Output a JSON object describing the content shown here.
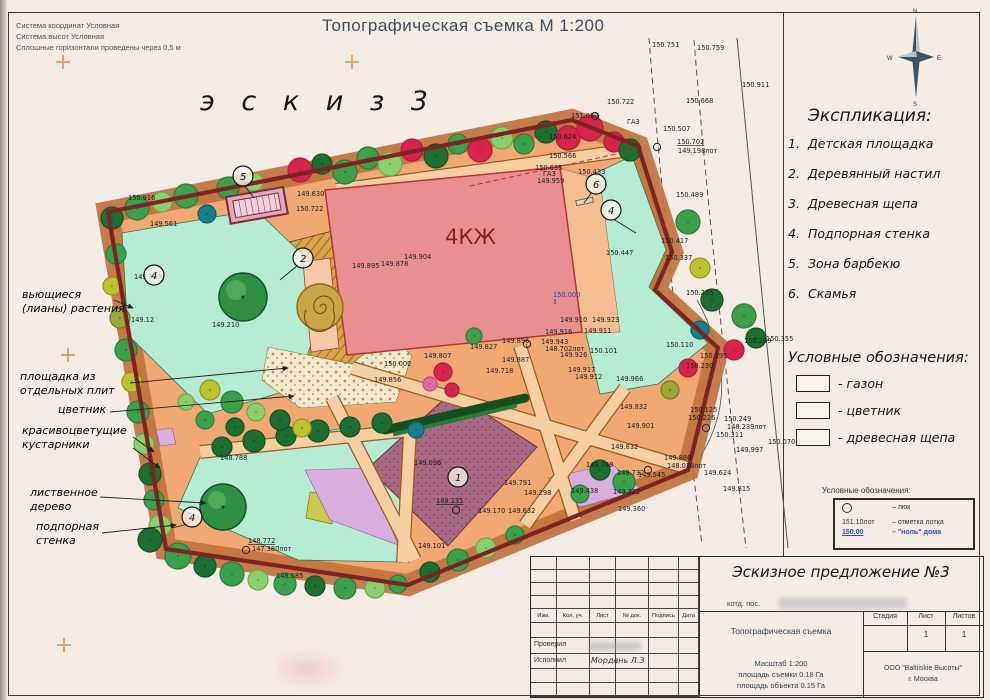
{
  "page": {
    "title": "Топографическая съемка М 1:200",
    "sketch_label": "э с к и з  3",
    "corner_notes": [
      "Система координат Условная",
      "Система высот Условная",
      "Сплошные горизонтали проведены через 0,5 м"
    ]
  },
  "compass": {
    "n": "N",
    "e": "E",
    "s": "S",
    "w": "W"
  },
  "explication": {
    "title": "Экспликация:",
    "items": [
      {
        "num": "1.",
        "label": "Детская площадка"
      },
      {
        "num": "2.",
        "label": "Деревянный настил"
      },
      {
        "num": "3.",
        "label": "Древесная щепа"
      },
      {
        "num": "4.",
        "label": "Подпорная стенка"
      },
      {
        "num": "5.",
        "label": "Зона барбекю"
      },
      {
        "num": "6.",
        "label": "Скамья"
      }
    ]
  },
  "legend": {
    "title": "Условные обозначения:",
    "items": [
      "газон",
      "цветник",
      "древесная щепа"
    ]
  },
  "legend_box": {
    "title": "Условные обозначения:",
    "rows": [
      {
        "value": "",
        "label": "–  люк",
        "symbol": "circle",
        "blue": false
      },
      {
        "value": "151.10лот",
        "label": "–  отметка лотка",
        "symbol": "",
        "blue": false
      },
      {
        "value": "150.00",
        "label": "–  \"ноль\" дома",
        "symbol": "",
        "blue": true
      }
    ]
  },
  "map": {
    "building_label": "4КЖ",
    "gas_label": "ГАЗ",
    "elevations": [
      {
        "v": "151.039",
        "x": 571,
        "y": 118
      },
      {
        "v": "150.722",
        "x": 607,
        "y": 104
      },
      {
        "v": "150.751",
        "x": 652,
        "y": 47
      },
      {
        "v": "150.759",
        "x": 697,
        "y": 50
      },
      {
        "v": "150.911",
        "x": 742,
        "y": 87
      },
      {
        "v": "150.668",
        "x": 686,
        "y": 103
      },
      {
        "v": "150.507",
        "x": 663,
        "y": 131
      },
      {
        "v": "150.702",
        "x": 677,
        "y": 144,
        "f": "u"
      },
      {
        "v": "149.198лот",
        "x": 678,
        "y": 153
      },
      {
        "v": "150.489",
        "x": 676,
        "y": 197
      },
      {
        "v": "150.417",
        "x": 661,
        "y": 243
      },
      {
        "v": "150.337",
        "x": 665,
        "y": 260
      },
      {
        "v": "150.205",
        "x": 686,
        "y": 295
      },
      {
        "v": "150.269",
        "x": 744,
        "y": 343
      },
      {
        "v": "150.355",
        "x": 766,
        "y": 341
      },
      {
        "v": "150.195",
        "x": 700,
        "y": 358
      },
      {
        "v": "150.230",
        "x": 686,
        "y": 368
      },
      {
        "v": "150.110",
        "x": 666,
        "y": 347
      },
      {
        "v": "150.125",
        "x": 690,
        "y": 412
      },
      {
        "v": "150.226",
        "x": 688,
        "y": 420
      },
      {
        "v": "150.249",
        "x": 724,
        "y": 421
      },
      {
        "v": "148.239лот",
        "x": 727,
        "y": 429
      },
      {
        "v": "150.311",
        "x": 716,
        "y": 437
      },
      {
        "v": "149.997",
        "x": 736,
        "y": 452
      },
      {
        "v": "150.070",
        "x": 768,
        "y": 444
      },
      {
        "v": "149.886",
        "x": 664,
        "y": 460
      },
      {
        "v": "148.038лот",
        "x": 667,
        "y": 468
      },
      {
        "v": "149.545",
        "x": 638,
        "y": 477
      },
      {
        "v": "149.624",
        "x": 704,
        "y": 475
      },
      {
        "v": "149.815",
        "x": 723,
        "y": 491
      },
      {
        "v": "149.360",
        "x": 618,
        "y": 511
      },
      {
        "v": "150.624",
        "x": 549,
        "y": 139
      },
      {
        "v": "150.566",
        "x": 549,
        "y": 158
      },
      {
        "v": "150.635",
        "x": 535,
        "y": 170
      },
      {
        "v": "149.959",
        "x": 537,
        "y": 183
      },
      {
        "v": "150.433",
        "x": 578,
        "y": 174
      },
      {
        "v": "149.630",
        "x": 297,
        "y": 196
      },
      {
        "v": "150.722",
        "x": 296,
        "y": 211
      },
      {
        "v": "150.916",
        "x": 128,
        "y": 200
      },
      {
        "v": "149.561",
        "x": 150,
        "y": 226
      },
      {
        "v": "149.339",
        "x": 134,
        "y": 279
      },
      {
        "v": "149.12",
        "x": 131,
        "y": 322
      },
      {
        "v": "149.210",
        "x": 212,
        "y": 327
      },
      {
        "v": "149.904",
        "x": 404,
        "y": 259
      },
      {
        "v": "149.895",
        "x": 352,
        "y": 268
      },
      {
        "v": "149.878",
        "x": 381,
        "y": 266
      },
      {
        "v": "150.447",
        "x": 606,
        "y": 255
      },
      {
        "v": "150.000",
        "x": 553,
        "y": 297,
        "f": "b"
      },
      {
        "v": "149.910",
        "x": 560,
        "y": 322
      },
      {
        "v": "149.923",
        "x": 592,
        "y": 322
      },
      {
        "v": "149.916",
        "x": 545,
        "y": 334
      },
      {
        "v": "149.911",
        "x": 584,
        "y": 333
      },
      {
        "v": "149.827",
        "x": 470,
        "y": 349
      },
      {
        "v": "149.896",
        "x": 502,
        "y": 343
      },
      {
        "v": "149.943",
        "x": 541,
        "y": 344
      },
      {
        "v": "148.702лот",
        "x": 545,
        "y": 351
      },
      {
        "v": "149.807",
        "x": 424,
        "y": 358
      },
      {
        "v": "149.887",
        "x": 502,
        "y": 362
      },
      {
        "v": "149.718",
        "x": 486,
        "y": 373
      },
      {
        "v": "149.926",
        "x": 560,
        "y": 357
      },
      {
        "v": "150.101",
        "x": 590,
        "y": 353
      },
      {
        "v": "149.917",
        "x": 568,
        "y": 372
      },
      {
        "v": "149.912",
        "x": 575,
        "y": 379
      },
      {
        "v": "149.966",
        "x": 616,
        "y": 381
      },
      {
        "v": "150.002",
        "x": 384,
        "y": 366
      },
      {
        "v": "149.856",
        "x": 374,
        "y": 382
      },
      {
        "v": "149.832",
        "x": 620,
        "y": 409
      },
      {
        "v": "149.901",
        "x": 627,
        "y": 428
      },
      {
        "v": "149.832",
        "x": 611,
        "y": 449
      },
      {
        "v": "149.798",
        "x": 586,
        "y": 467
      },
      {
        "v": "149.732",
        "x": 617,
        "y": 475
      },
      {
        "v": "149.791",
        "x": 504,
        "y": 485
      },
      {
        "v": "149.298",
        "x": 524,
        "y": 495
      },
      {
        "v": "149.438",
        "x": 571,
        "y": 493
      },
      {
        "v": "149.722",
        "x": 613,
        "y": 494
      },
      {
        "v": "149.096",
        "x": 414,
        "y": 465
      },
      {
        "v": "149.235",
        "x": 436,
        "y": 503,
        "f": "u"
      },
      {
        "v": "149.170",
        "x": 478,
        "y": 513
      },
      {
        "v": "149.632",
        "x": 508,
        "y": 513
      },
      {
        "v": "148.788",
        "x": 220,
        "y": 460
      },
      {
        "v": "148.772",
        "x": 248,
        "y": 543,
        "f": "u"
      },
      {
        "v": "147.380лот",
        "x": 252,
        "y": 551
      },
      {
        "v": "148.585",
        "x": 276,
        "y": 578
      },
      {
        "v": "149.101",
        "x": 418,
        "y": 548
      }
    ],
    "manholes": [
      [
        657,
        147
      ],
      [
        595,
        116
      ],
      [
        527,
        344
      ],
      [
        706,
        428
      ],
      [
        648,
        470
      ],
      [
        456,
        510
      ],
      [
        246,
        550
      ]
    ],
    "callouts": [
      {
        "n": "1",
        "x": 458,
        "y": 477
      },
      {
        "n": "2",
        "x": 303,
        "y": 258
      },
      {
        "n": "4",
        "x": 154,
        "y": 275
      },
      {
        "n": "4",
        "x": 611,
        "y": 210
      },
      {
        "n": "4",
        "x": 192,
        "y": 517
      },
      {
        "n": "5",
        "x": 243,
        "y": 176
      },
      {
        "n": "6",
        "x": 596,
        "y": 184
      }
    ],
    "annotations": [
      {
        "lines": [
          "вьющиеся",
          "(лианы) растения"
        ],
        "x": 22,
        "y": 298,
        "leaders": [
          [
            114,
            300,
            133,
            308
          ]
        ]
      },
      {
        "lines": [
          "площадка из",
          "отдельных плит"
        ],
        "x": 20,
        "y": 380,
        "leaders": [
          [
            130,
            383,
            288,
            368
          ]
        ]
      },
      {
        "lines": [
          "цветник"
        ],
        "x": 58,
        "y": 413,
        "leaders": [
          [
            110,
            412,
            294,
            396
          ]
        ]
      },
      {
        "lines": [
          "красивоцветущие",
          "кустарники"
        ],
        "x": 22,
        "y": 434,
        "leaders": [
          [
            133,
            437,
            154,
            452
          ],
          [
            133,
            448,
            160,
            468
          ]
        ]
      },
      {
        "lines": [
          "лиственное",
          "дерево"
        ],
        "x": 30,
        "y": 496,
        "leaders": [
          [
            100,
            497,
            206,
            503
          ]
        ]
      },
      {
        "lines": [
          "подпорная",
          "стенка"
        ],
        "x": 36,
        "y": 530,
        "leaders": [
          [
            102,
            533,
            176,
            525
          ]
        ]
      }
    ]
  },
  "titleblock": {
    "sketch_title": "Эскизное предложение №3",
    "kotd": "котд. пос.",
    "cols": [
      "Изм.",
      "Кол. уч.",
      "Лист",
      "№ док.",
      "Подпись",
      "Дата"
    ],
    "row_checked": "Проверил",
    "row_made": "Исполнил",
    "made_by": "Мордань Л.З",
    "doc_title": "Топографическая съемка",
    "stage_cols": [
      "Стадия",
      "Лист",
      "Листов"
    ],
    "sheet_num": "1",
    "sheets_total": "1",
    "scale_lines": [
      "Масштаб 1:200",
      "площадь съемки 0.18 Га",
      "площадь объекта 0.15 Га"
    ],
    "company_lines": [
      "ООО \"Baltiiskie Высоты\"",
      "г. Москва"
    ]
  }
}
